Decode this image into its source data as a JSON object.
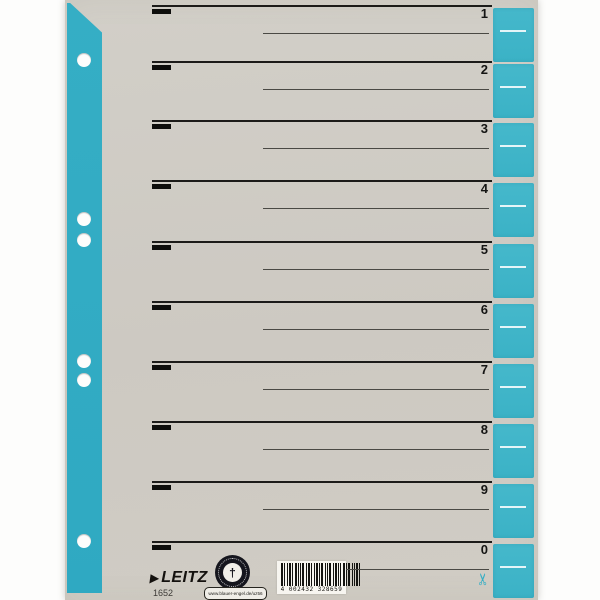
{
  "divider": {
    "brand": "LEITZ",
    "brand_arrow": "▶",
    "product_number": "1652",
    "tabs": [
      "1",
      "2",
      "3",
      "4",
      "5",
      "6",
      "7",
      "8",
      "9",
      "0"
    ],
    "eco_badge": {
      "ring_text": "BLAUER ENGEL",
      "center_glyph": "†",
      "url_label": "www.blauer-engel.de/uz56"
    },
    "barcode_digits": "4 002432 328659",
    "scissors_glyph": "✂",
    "colors": {
      "strip_blue": "#35aec5",
      "strip_blue2": "#2fa9c2",
      "tab_blue": "#45b8cb",
      "tab_blue2": "#3bb2c6",
      "card_grey": "#cfcbc4",
      "ink_black": "#161614",
      "background": "#fdfdfc"
    }
  }
}
